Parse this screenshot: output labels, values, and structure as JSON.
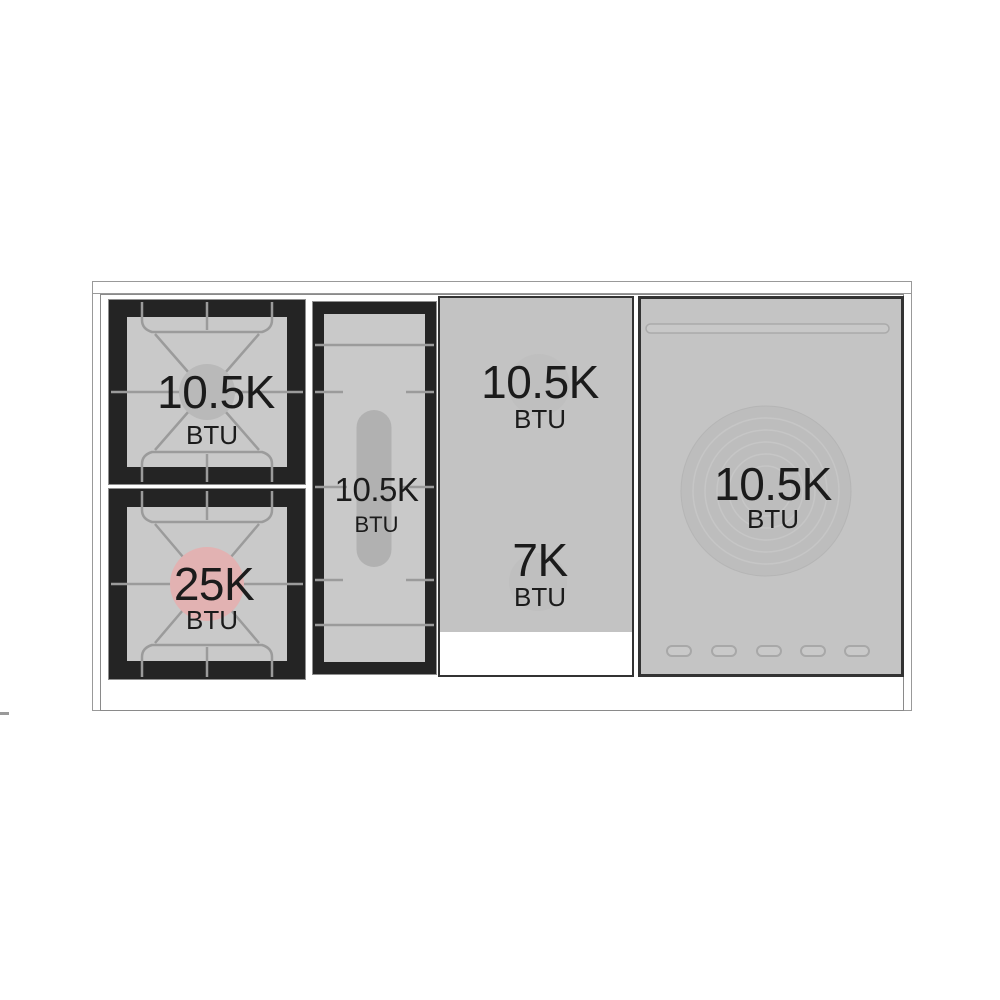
{
  "diagram": {
    "name": "range-cooktop-btu-diagram",
    "units": {
      "burner_top_left": {
        "power": "10.5K",
        "unit": "BTU"
      },
      "burner_bottom_left": {
        "power": "25K",
        "unit": "BTU"
      },
      "griddle_burner": {
        "power": "10.5K",
        "unit": "BTU"
      },
      "dual_zone_top": {
        "power": "10.5K",
        "unit": "BTU"
      },
      "dual_zone_bottom": {
        "power": "7K",
        "unit": "BTU"
      },
      "french_top": {
        "power": "10.5K",
        "unit": "BTU"
      }
    },
    "colors": {
      "surface_gray": "#c4c4c4",
      "grate_frame_black": "#242424",
      "grate_line_gray": "#9b9b9b",
      "burner_cap_gray": "#b9b9b9",
      "high_power_pink": "#e2b2b2",
      "griddle_pill_gray": "#b1b1b1",
      "french_plate_gray": "#bdbdbd",
      "text_black": "#1b1b1b",
      "outline_gray": "#999999"
    }
  }
}
